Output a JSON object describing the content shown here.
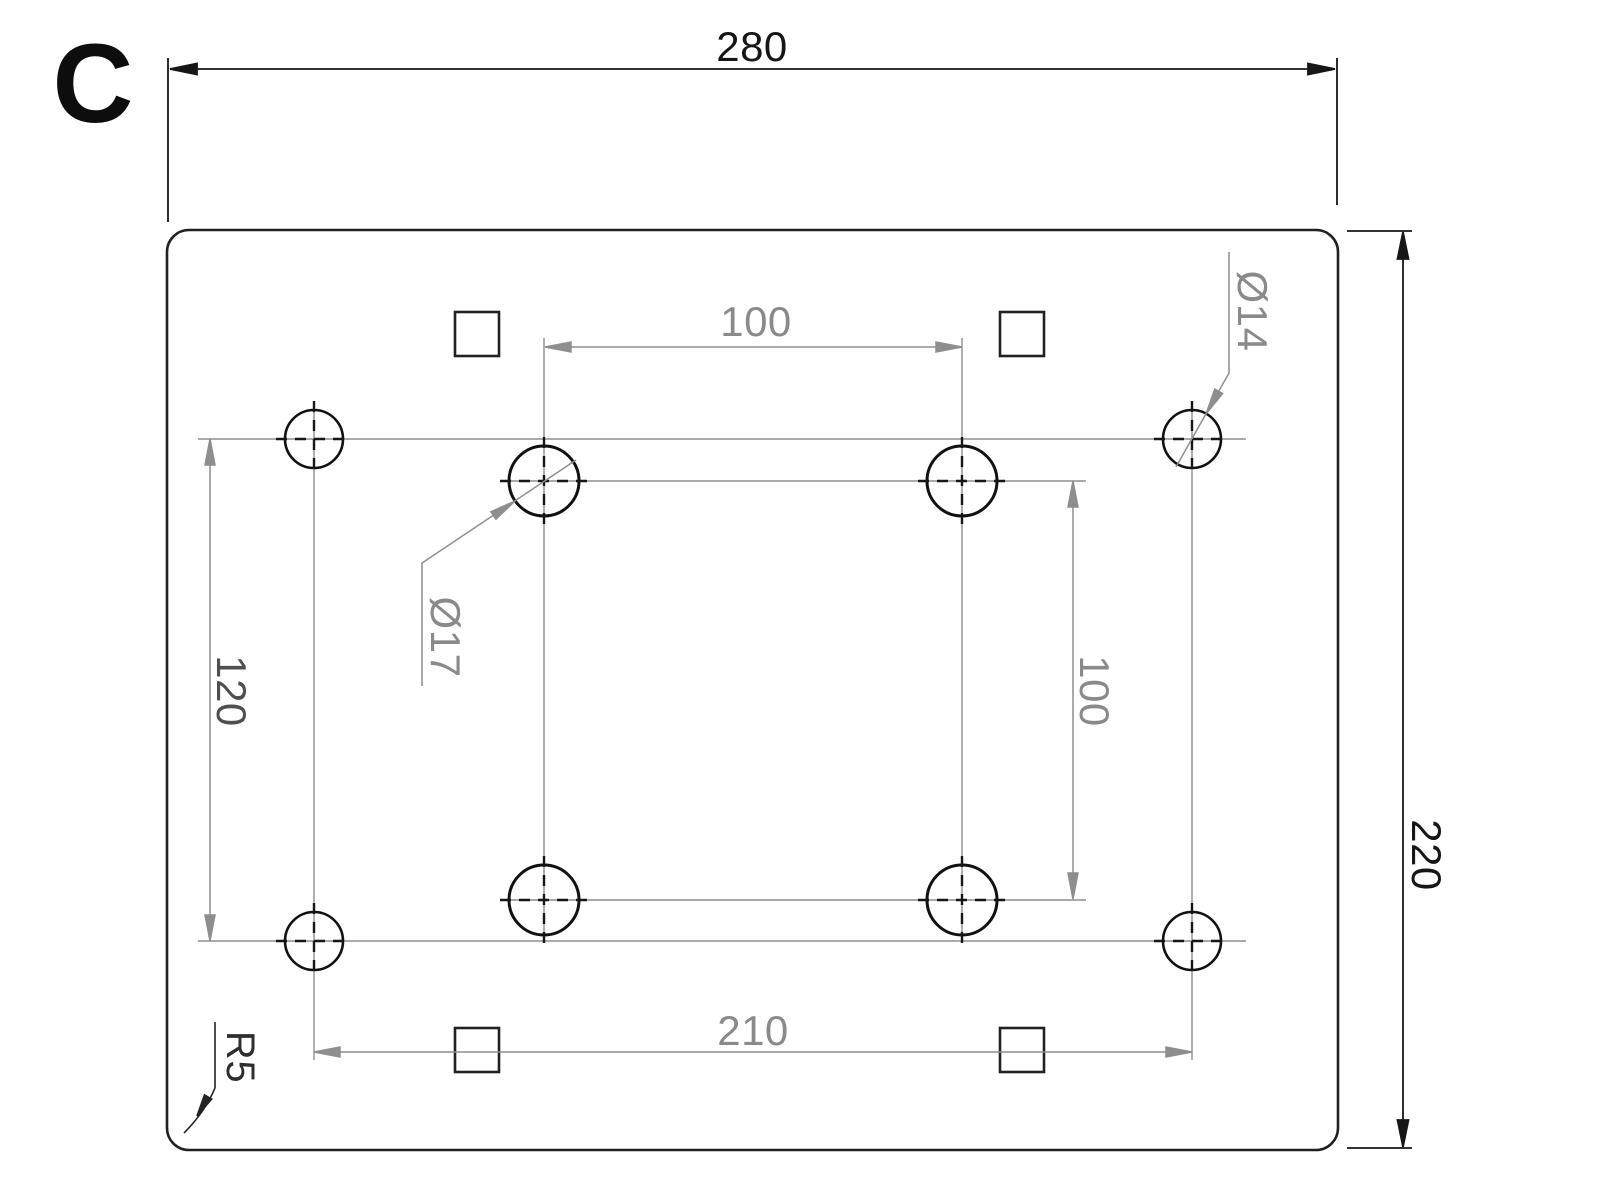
{
  "view_label": "C",
  "dimensions": {
    "overall_width": "280",
    "overall_height": "220",
    "center_hole_spacing_horizontal": "100",
    "center_hole_spacing_vertical": "100",
    "corner_hole_spacing_vertical": "120",
    "corner_hole_spacing_horizontal": "210",
    "corner_hole_diameter": "Ø14",
    "center_hole_diameter": "Ø17",
    "corner_radius": "R5"
  },
  "features": {
    "corner_holes_count": "4",
    "center_holes_count": "4",
    "square_openings_count": "4"
  },
  "colors": {
    "outline": "#212121",
    "dimension_gray": "#8e8e8e",
    "text_black": "#161616",
    "text_gray": "#8a8a8a"
  }
}
